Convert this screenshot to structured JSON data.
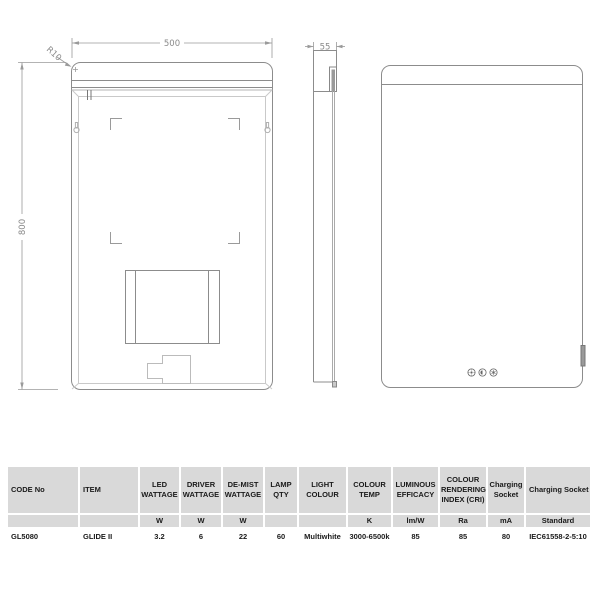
{
  "colors": {
    "table_header_bg": "#d9d9d9",
    "drawing_line": "#8c8c8c",
    "dim_line": "#9a9a9a"
  },
  "drawings": {
    "back_view": {
      "width_label": "500",
      "height_label": "800",
      "radius_label": "R10"
    },
    "side_view": {
      "depth_label": "55"
    },
    "front_view": {
      "touch_buttons": [
        "brightness",
        "colour-change",
        "demist"
      ]
    }
  },
  "spec_table": {
    "columns": [
      {
        "label": "CODE No",
        "unit": ""
      },
      {
        "label": "ITEM",
        "unit": ""
      },
      {
        "label": "LED WATTAGE",
        "unit": "W"
      },
      {
        "label": "DRIVER WATTAGE",
        "unit": "W"
      },
      {
        "label": "DE-MIST WATTAGE",
        "unit": "W"
      },
      {
        "label": "LAMP QTY",
        "unit": ""
      },
      {
        "label": "LIGHT COLOUR",
        "unit": ""
      },
      {
        "label": "COLOUR TEMP",
        "unit": "K"
      },
      {
        "label": "LUMINOUS EFFICACY",
        "unit": "lm/W"
      },
      {
        "label": "COLOUR RENDERING INDEX (CRI)",
        "unit": "Ra"
      },
      {
        "label": "Charging Socket",
        "unit": "mA"
      },
      {
        "label": "Charging Socket",
        "unit": "Standard"
      }
    ],
    "row": [
      "GL5080",
      "GLIDE II",
      "3.2",
      "6",
      "22",
      "60",
      "Multiwhite",
      "3000-6500k",
      "85",
      "85",
      "80",
      "IEC61558-2-5:10"
    ]
  }
}
